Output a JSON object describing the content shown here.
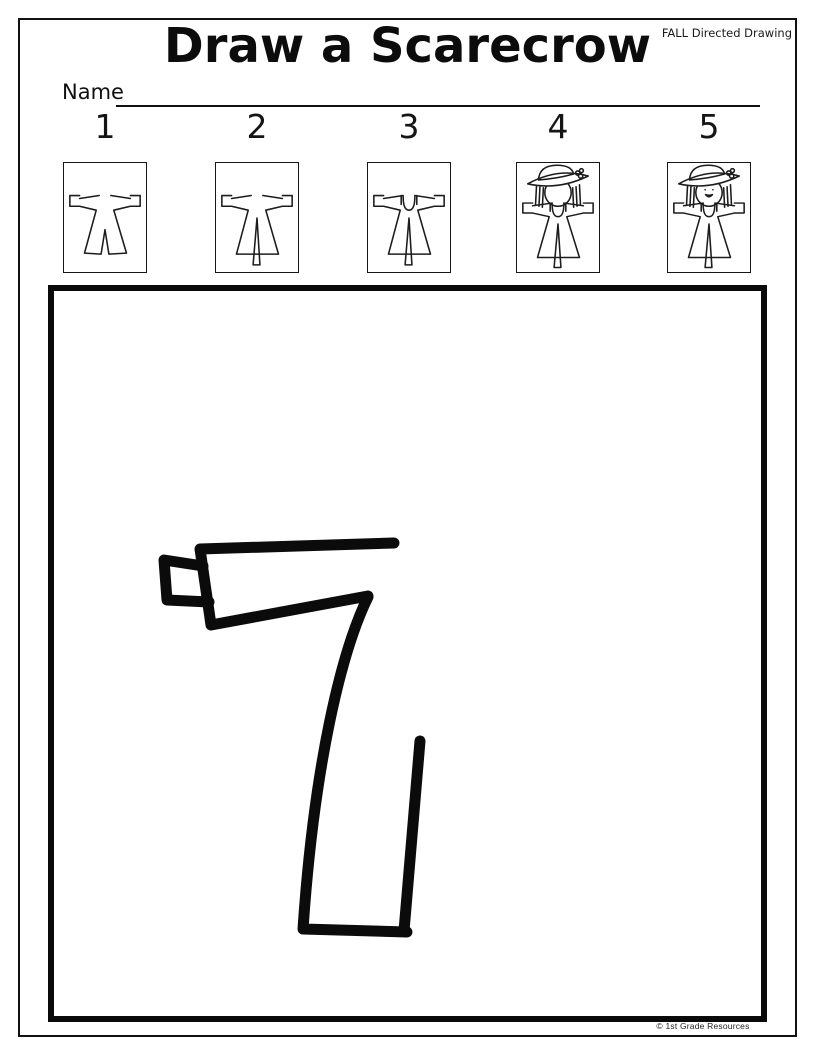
{
  "page": {
    "title": "Draw a Scarecrow",
    "corner_label": "FALL Directed Drawing",
    "name_label": "Name",
    "footer_credit": "© 1st Grade Resources"
  },
  "colors": {
    "ink": "#111111",
    "paper": "#ffffff",
    "canvas_border": "#0a0a0a",
    "drawing_stroke": "#0b0b0b"
  },
  "steps": [
    {
      "number": "1",
      "image": "scarecrow-shirt"
    },
    {
      "number": "2",
      "image": "scarecrow-shirt-pole"
    },
    {
      "number": "3",
      "image": "scarecrow-overalls"
    },
    {
      "number": "4",
      "image": "scarecrow-head-hat"
    },
    {
      "number": "5",
      "image": "scarecrow-face"
    }
  ],
  "figures": {
    "shirt_legs": "M16 36 L36 33 M48 33 L68 36 M16 33 L6 33 L6 44 L16 44 M68 33 L78 33 L78 44 L68 44 M16 44 L33 48 L21 92 L38 93 L42 68 L46 93 L64 92 L51 48 L68 44",
    "tunic": "M16 36 L36 33 M48 33 L68 36 M16 33 L6 33 L6 44 L16 44 M68 33 L78 33 L78 44 L68 44 M16 44 L33 48 L21 93 L64 93 L51 48 L68 44",
    "pole": "M42 56 L38 104 L45 104 Z",
    "overalls": "M34 33 L34 42 M50 33 L50 42 M36 34 Q36 48 42 48 Q48 48 48 34",
    "head_face": "M28.5 30 A13.5 14 0 1 0 55.5 30 A13.5 14 0 1 0 28.5 30",
    "hat": "M22 17 Q23 2 41 2 Q56 2 58 11 Q40 16 22 17 Z M11 21 Q42 28 73 13 Q42 4 11 21 Z",
    "hair": "M20 23 L19 42 M23.5 24 L22.5 44 M27 25 L26 45 M57 25 L58 45 M60.5 24 L61.5 44 M64 22 L65 42",
    "flower": "M60 10 A2.2 2.2 0 1 0 64.4 10 A2.2 2.2 0 1 0 60 10 M63 13 A2.2 2.2 0 1 0 67.4 13 A2.2 2.2 0 1 0 63 13 M64 7.5 A2 2 0 1 0 68 7.5 A2 2 0 1 0 64 7.5",
    "face": "M38 27 L38 27.01 M46 27 L46 27.01 M38.5 32 Q42 36.5 45.5 32 Q42 33.5 38.5 32"
  },
  "canvas": {
    "stroke_width": 11,
    "strokes": {
      "arm_outline": "M394 543 L200 549 L211 625 L368 596",
      "cuff": "M203 566 L164 560 L167 600 L209 602",
      "body_and_hem": "M368 597 C341 652 314 766 303 929 L407 932",
      "right_side": "M404 931 L420 741"
    }
  }
}
